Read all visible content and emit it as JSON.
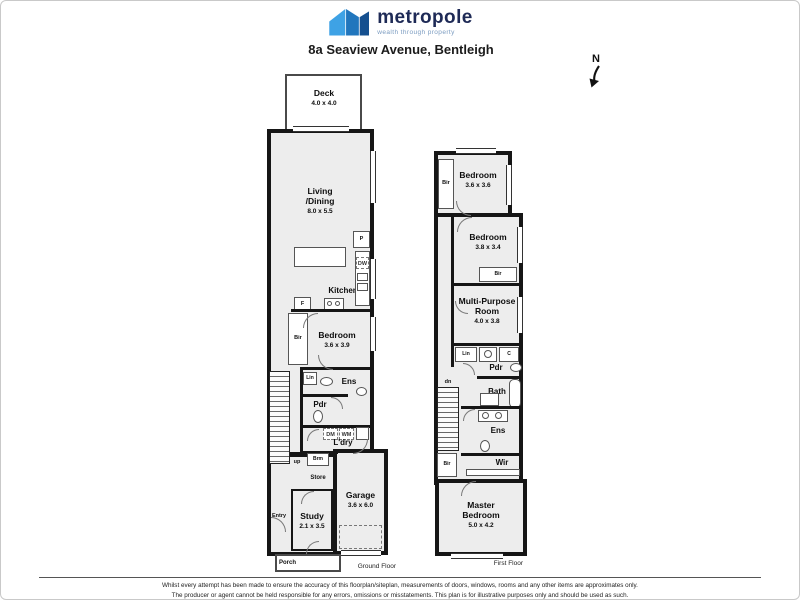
{
  "header": {
    "brand": "metropole",
    "tagline": "wealth through property",
    "address": "8a Seaview Avenue, Bentleigh",
    "compass_n": "N"
  },
  "colors": {
    "wall": "#161616",
    "room_fill": "#ededed",
    "brand_navy": "#1e2a56",
    "logo_light_blue": "#3ea2e5",
    "logo_mid_blue": "#2176bd",
    "logo_dark_blue": "#15508f",
    "tagline_blue": "#7a9bc0"
  },
  "gf": {
    "floor_label": "Ground Floor",
    "rooms": {
      "deck": {
        "name": "Deck",
        "dims": "4.0 x 4.0"
      },
      "living_dining": {
        "name": "Living\n/Dining",
        "dims": "8.0 x 5.5"
      },
      "kitchen": {
        "name": "Kitchen"
      },
      "bedroom": {
        "name": "Bedroom",
        "dims": "3.6 x 3.9"
      },
      "ensuite": {
        "name": "Ens"
      },
      "powder": {
        "name": "Pdr"
      },
      "laundry": {
        "name": "L'dry"
      },
      "garage": {
        "name": "Garage",
        "dims": "3.6 x 6.0"
      },
      "study": {
        "name": "Study",
        "dims": "2.1 x 3.5"
      },
      "porch": {
        "name": "Porch"
      },
      "entry": {
        "name": "Entry"
      }
    },
    "tags": {
      "pantry": "P",
      "dishwasher": "DW",
      "fridge": "F",
      "robe": "Bir",
      "linen": "Lin",
      "dryer": "DM",
      "washer": "WM",
      "broom": "Brm",
      "store": "Store",
      "stairs": "up"
    }
  },
  "ff": {
    "floor_label": "First Floor",
    "rooms": {
      "bedroom2": {
        "name": "Bedroom",
        "dims": "3.6 x 3.6"
      },
      "bedroom3": {
        "name": "Bedroom",
        "dims": "3.8 x 3.4"
      },
      "multipurpose": {
        "name": "Multi-Purpose\nRoom",
        "dims": "4.0 x 3.8"
      },
      "powder": {
        "name": "Pdr"
      },
      "bath": {
        "name": "Bath"
      },
      "ensuite": {
        "name": "Ens"
      },
      "wir": {
        "name": "Wir"
      },
      "master": {
        "name": "Master\nBedroom",
        "dims": "5.0 x 4.2"
      }
    },
    "tags": {
      "robe2": "Bir",
      "robe3": "Bir",
      "robe_master": "Bir",
      "linen": "Lin",
      "cupboard": "C",
      "stairs": "dn"
    }
  },
  "footer": {
    "line1": "Whilst every attempt has been made to ensure the accuracy of this floorplan/siteplan, measurements of doors, windows, rooms and any other items are approximates only.",
    "line2": "The producer or agent cannot be held responsible for any errors, omissions or misstatements. This plan is for illustrative purposes only and should be used as such."
  }
}
